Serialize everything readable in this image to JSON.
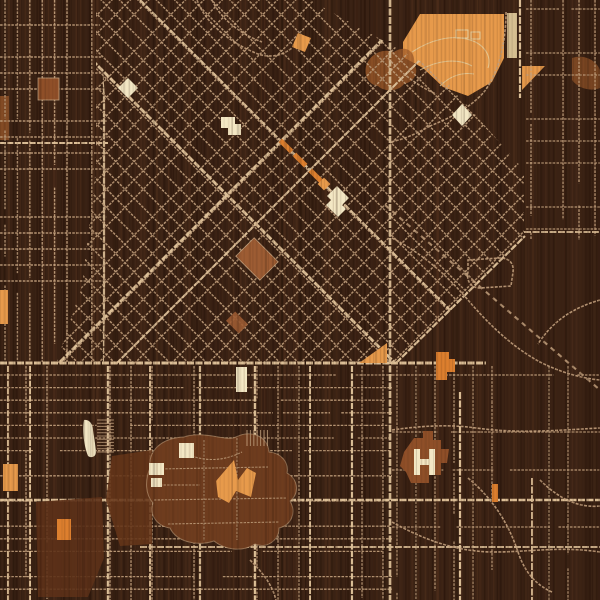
{
  "meta": {
    "title": "engraved-wood-city-street-map",
    "canvas_w": 600,
    "canvas_h": 600
  },
  "palette": {
    "bg": "#3a2214",
    "grainDark": "#231108",
    "grainLight": "#5a3620",
    "street": "#c2a07d",
    "streetBright": "#dcbf97",
    "cream": "#f3e7c4",
    "creamDim": "#e6cf9f",
    "orange": "#e79a4b",
    "orangeDeep": "#dd7f2e",
    "rust": "#a35d2b",
    "copper": "#8f4f28",
    "terracotta": "#9d5c33",
    "campus": "#6e3c1e",
    "campusB": "#5d3118",
    "campusA": "#653619"
  },
  "wood": {
    "stripe_step": 4,
    "stripe_count": 152,
    "plank_count": 13,
    "under_opacity": 0.32,
    "over_opacity": 0.14
  },
  "grids": [
    {
      "name": "left-ortho-grid",
      "kind": "ortho",
      "clip": "0,0 98,0 108,140 104,362 0,362",
      "bbox": [
        0,
        0,
        118,
        362
      ],
      "sx": 12.4,
      "sy": 16,
      "w": 1.4,
      "skipV": 0.08,
      "skipH": 0.3,
      "gap": 0.3,
      "majors": [
        {
          "axis": "v",
          "pos": 104,
          "w": 2.2,
          "a": 0,
          "b": 362
        },
        {
          "axis": "h",
          "pos": 143,
          "w": 2.0,
          "a": 0,
          "b": 110
        }
      ]
    },
    {
      "name": "downtown-diagonal-grid",
      "kind": "diag",
      "clip": "96,0 310,0 436,70 524,170 524,238 396,364 56,364 82,285 96,168",
      "bbox": [
        40,
        -20,
        540,
        380
      ],
      "spacing": 13,
      "w": 1.5,
      "skip": 0.07
    },
    {
      "name": "south-rows-grid",
      "kind": "ortho",
      "clip": "0,366 392,366 392,600 0,600",
      "bbox": [
        0,
        366,
        392,
        600
      ],
      "sx": 21,
      "sy": 12.6,
      "w": 1.3,
      "skipV": 0.45,
      "skipH": 0.12,
      "gap": 0.3,
      "majors": [
        {
          "axis": "v",
          "pos": 8,
          "w": 2.0,
          "a": 366,
          "b": 600
        },
        {
          "axis": "v",
          "pos": 30,
          "w": 2.0,
          "a": 366,
          "b": 600
        },
        {
          "axis": "v",
          "pos": 108,
          "w": 2.4,
          "a": 366,
          "b": 600
        },
        {
          "axis": "v",
          "pos": 150,
          "w": 2.0,
          "a": 366,
          "b": 600
        },
        {
          "axis": "v",
          "pos": 200,
          "w": 2.2,
          "a": 366,
          "b": 600
        },
        {
          "axis": "v",
          "pos": 255,
          "w": 2.4,
          "a": 366,
          "b": 600
        },
        {
          "axis": "v",
          "pos": 310,
          "w": 2.0,
          "a": 366,
          "b": 600
        },
        {
          "axis": "v",
          "pos": 352,
          "w": 2.2,
          "a": 366,
          "b": 600
        }
      ]
    },
    {
      "name": "northeast-ortho-grid",
      "kind": "ortho",
      "clip": "526,0 600,0 600,240 526,240",
      "bbox": [
        526,
        0,
        600,
        240
      ],
      "sx": 16,
      "sy": 22,
      "w": 1.3,
      "skipV": 0.25,
      "skipH": 0.3,
      "gap": 0.4,
      "majors": []
    },
    {
      "name": "southeast-sparse-grid",
      "kind": "ortho",
      "clip": "392,366 600,366 600,600 392,600",
      "bbox": [
        392,
        366,
        600,
        600
      ],
      "sx": 19,
      "sy": 19,
      "w": 1.2,
      "skipV": 0.5,
      "skipH": 0.5,
      "gap": 0.5,
      "majors": []
    }
  ],
  "major_roads": [
    {
      "name": "main-avenue-nw-se-1",
      "d": "M32,0 L394,362",
      "w": 2.8,
      "clip": 1
    },
    {
      "name": "main-avenue-nw-se-2",
      "d": "M140,0 L502,362",
      "w": 2.2,
      "clip": 1
    },
    {
      "name": "main-avenue-ne-sw-1",
      "d": "M60,362 L422,0",
      "w": 2.8,
      "clip": 1
    },
    {
      "name": "main-avenue-ne-sw-2",
      "d": "M116,364 L480,0",
      "w": 2.0,
      "clip": 1
    },
    {
      "name": "grid-edge-avenue",
      "d": "M396,363 L525,236",
      "w": 2.2
    },
    {
      "name": "cross-town-street",
      "d": "M0,363 L486,363",
      "w": 3.0
    },
    {
      "name": "south-arterial-1",
      "d": "M0,500 L600,500",
      "w": 2.4
    },
    {
      "name": "south-arterial-2",
      "d": "M140,547 L600,547",
      "w": 1.8
    },
    {
      "name": "north-south-arterial",
      "d": "M390,0 L390,600",
      "w": 2.6
    },
    {
      "name": "east-arterial",
      "d": "M460,392 L460,600",
      "w": 2.2
    },
    {
      "name": "park-east-street",
      "d": "M520,0 L520,98",
      "w": 2.2
    },
    {
      "name": "southeast-street",
      "d": "M532,478 L532,600",
      "w": 1.8
    },
    {
      "name": "northeast-cross-street",
      "d": "M524,232 L600,232",
      "w": 1.8
    }
  ],
  "railway": {
    "name": "railway-line",
    "d": "M385,205 L600,390",
    "w": 2.1,
    "dash": "5 4.5",
    "op": 0.85
  },
  "minor_roads": [
    {
      "name": "top-curve-road-1",
      "d": "M197,0 C205,22 228,42 258,54 C270,58 282,56 292,48"
    },
    {
      "name": "top-curve-road-2",
      "d": "M212,0 C220,18 240,34 262,42"
    },
    {
      "name": "park-edge-road",
      "d": "M506,12 C506,44 498,74 484,92 C470,108 450,118 430,126"
    },
    {
      "name": "park-connector-road",
      "d": "M388,58 C402,74 418,86 436,94"
    },
    {
      "name": "park-south-road",
      "d": "M430,126 C416,134 402,140 390,142"
    },
    {
      "name": "valley-curve-road-1",
      "d": "M392,238 C420,252 446,274 468,300 C490,326 514,348 540,362 C560,372 580,378 600,380"
    },
    {
      "name": "valley-curve-road-2",
      "d": "M600,300 C572,308 552,322 538,344"
    },
    {
      "name": "loop-road",
      "d": "M468,260 L500,258 C510,258 514,264 513,272 L511,286 L480,288 C472,288 466,282 468,272 Z"
    },
    {
      "name": "hospital-access-road",
      "d": "M392,430 C420,426 448,424 476,428 C520,434 560,430 600,428"
    },
    {
      "name": "southeast-curve-road-1",
      "d": "M468,478 C492,498 508,522 518,552 C524,570 534,584 552,592"
    },
    {
      "name": "southeast-curve-road-2",
      "d": "M392,522 C424,540 458,552 494,552 C530,552 560,546 600,552"
    },
    {
      "name": "southeast-curve-road-3",
      "d": "M540,480 C560,500 580,508 600,506"
    },
    {
      "name": "south-small-curve",
      "d": "M250,560 C262,572 272,584 276,600"
    }
  ],
  "regions_under": [
    {
      "name": "city-park",
      "shape": "polygon",
      "pts": "403,42 420,14 504,14 504,58 492,82 468,96 443,87 423,68 403,57",
      "fill": "orange"
    },
    {
      "name": "park-strip-field",
      "shape": "rect",
      "x": 507,
      "y": 13,
      "w": 10,
      "h": 45,
      "fill": "creamDim",
      "op": 0.9
    },
    {
      "name": "park-triangle",
      "shape": "polygon",
      "pts": "522,66 545,66 522,90",
      "fill": "orange"
    },
    {
      "name": "wood-knot-rust-patch",
      "shape": "path",
      "d": "M366,66 C370,54 382,48 394,52 C406,44 416,52 414,64 C420,72 414,82 404,84 C398,92 384,92 378,86 C368,84 364,76 366,66 Z",
      "fill": "rust",
      "op": 0.75
    },
    {
      "name": "rust-patch-east",
      "shape": "path",
      "d": "M572,58 C584,54 596,60 600,70 L600,88 C590,92 578,88 572,80 Z",
      "fill": "rust",
      "op": 0.6
    },
    {
      "name": "rust-strip-west",
      "shape": "rect",
      "x": 0,
      "y": 96,
      "w": 9,
      "h": 44,
      "fill": "rust",
      "op": 0.7
    }
  ],
  "regions_over": [
    {
      "name": "campus-area-west",
      "shape": "polygon",
      "pts": "112,456 152,450 152,544 120,546 106,500",
      "fill": "campusA",
      "op": 0.88
    },
    {
      "name": "campus-area-south",
      "shape": "polygon",
      "pts": "36,502 102,497 104,558 88,597 38,597",
      "fill": "campusB",
      "op": 0.9
    },
    {
      "name": "campus-main-blob",
      "shape": "path",
      "d": "M150,468 C148,450 162,438 184,437 C204,430 226,442 236,437 C252,429 268,437 269,452 C281,453 289,462 287,473 C299,480 299,494 290,501 C297,513 291,525 279,528 C279,541 266,549 255,544 C241,553 224,549 214,541 C196,547 176,541 170,528 C157,526 149,515 153,503 C145,494 145,480 150,468 Z",
      "fill": "campus",
      "stroke": "street",
      "sw": 1,
      "sop": 0.6
    },
    {
      "name": "hospital-building",
      "shape": "path",
      "d": "M400,466 L404,452 L414,438 L423,438 L423,431 L433,431 L433,440 L441,440 L441,449 L449,449 L447,463 L441,463 L441,475 L429,475 L429,483 L411,483 L406,472 Z",
      "fill": "copper"
    }
  ],
  "campus_paths": [
    {
      "name": "campus-walk",
      "d": "M158,469 L268,467"
    },
    {
      "name": "campus-walk",
      "d": "M154,500 L287,498"
    },
    {
      "name": "campus-walk",
      "d": "M168,524 L279,522"
    },
    {
      "name": "campus-walk",
      "d": "M204,440 L204,541"
    },
    {
      "name": "campus-walk",
      "d": "M237,438 L237,540"
    },
    {
      "name": "campus-walk",
      "d": "M182,452 C202,462 222,462 242,452"
    },
    {
      "name": "campus-walk",
      "d": "M160,485 L200,485"
    }
  ],
  "park_trails": [
    {
      "name": "park-trail",
      "d": "M412,52 C430,40 452,34 470,40 C484,44 492,56 488,68"
    },
    {
      "name": "park-trail",
      "d": "M420,70 C438,60 458,58 472,66"
    },
    {
      "name": "park-trail",
      "d": "M440,86 C450,76 462,72 474,74"
    }
  ],
  "combs": [
    {
      "name": "trailer-rows",
      "x": 97,
      "y": 420,
      "n": 11,
      "step": 3.2,
      "len": 17,
      "dir": "h"
    },
    {
      "name": "parking-rows",
      "x": 247,
      "y": 430,
      "n": 7,
      "step": 3.4,
      "len": 16,
      "dir": "v"
    }
  ],
  "landmarks": [
    {
      "name": "park-shelter-outline",
      "shape": "rect",
      "x": 456,
      "y": 30,
      "w": 12,
      "h": 8,
      "fill": "none",
      "stroke": "creamDim",
      "sw": 1
    },
    {
      "name": "park-shelter-outline",
      "shape": "rect",
      "x": 471,
      "y": 32,
      "w": 9,
      "h": 7,
      "fill": "none",
      "stroke": "creamDim",
      "sw": 1
    },
    {
      "name": "copper-block",
      "shape": "rect",
      "x": 38,
      "y": 78,
      "w": 21,
      "h": 22,
      "fill": "copper",
      "stroke": "street",
      "sw": 0.8
    },
    {
      "name": "landmark-diamond-west",
      "shape": "polygon",
      "pts": "128,78 138,88 128,98 118,88",
      "fill": "cream"
    },
    {
      "name": "landmark-L-building",
      "shape": "path",
      "d": "M221,117 L235,117 L235,124 L241,124 L241,135 L228,135 L228,128 L221,128 Z",
      "fill": "cream"
    },
    {
      "name": "orange-parallelogram",
      "shape": "polygon",
      "pts": "298,33 311,38 305,52 292,47",
      "fill": "orange"
    },
    {
      "name": "avenue-orange-strip",
      "shape": "rect",
      "x": 278,
      "y": 143.5,
      "w": 16,
      "h": 5,
      "rot": 45,
      "fill": "orangeDeep"
    },
    {
      "name": "avenue-orange-strip",
      "shape": "rect",
      "x": 292,
      "y": 157.5,
      "w": 16,
      "h": 5,
      "rot": 45,
      "fill": "orangeDeep"
    },
    {
      "name": "avenue-orange-strip",
      "shape": "rect",
      "x": 308,
      "y": 173.5,
      "w": 16,
      "h": 5,
      "rot": 45,
      "fill": "orangeDeep"
    },
    {
      "name": "avenue-orange-block",
      "shape": "rect",
      "x": 319.5,
      "y": 179.5,
      "w": 9,
      "h": 9,
      "rot": 45,
      "fill": "orange"
    },
    {
      "name": "landmark-G-building",
      "shape": "path",
      "d": "M327,196 L337,186 L349,198 L342,205 L346,209 L338,217 L326,205 L331,200 Z",
      "fill": "cream"
    },
    {
      "name": "terracotta-block-large",
      "shape": "rect",
      "x": 240,
      "y": 246,
      "w": 34,
      "h": 26,
      "rot": 45,
      "fill": "terracotta",
      "stroke": "street",
      "sw": 0.8
    },
    {
      "name": "terracotta-block-small",
      "shape": "rect",
      "x": 228,
      "y": 316,
      "w": 18,
      "h": 13,
      "rot": 45,
      "fill": "terracotta",
      "op": 0.9
    },
    {
      "name": "landmark-diamond-east",
      "shape": "polygon",
      "pts": "462,104 472,115 462,126 452,115",
      "fill": "cream"
    },
    {
      "name": "orange-pennant",
      "shape": "polygon",
      "pts": "359,363 387,343 387,363",
      "fill": "orange"
    },
    {
      "name": "orange-stair-block",
      "shape": "path",
      "d": "M436,352 L449,352 L449,359 L455,359 L455,372 L447,372 L447,380 L436,380 Z",
      "fill": "orangeDeep"
    },
    {
      "name": "orange-strip-west-edge",
      "shape": "rect",
      "x": 0,
      "y": 290,
      "w": 8,
      "h": 34,
      "fill": "orange"
    },
    {
      "name": "orange-block-west",
      "shape": "rect",
      "x": 3,
      "y": 464,
      "w": 15,
      "h": 27,
      "fill": "orange"
    },
    {
      "name": "orange-block-south",
      "shape": "rect",
      "x": 57,
      "y": 519,
      "w": 14,
      "h": 21,
      "fill": "orangeDeep"
    },
    {
      "name": "orange-sliver-east",
      "shape": "rect",
      "x": 492,
      "y": 484,
      "w": 6,
      "h": 18,
      "fill": "orangeDeep"
    },
    {
      "name": "campus-orange-halls",
      "shape": "path",
      "d": "M216,481 L234,460 L238,480 L247,468 L256,473 L251,497 L236,491 L229,503 L218,497 Z",
      "fill": "orange"
    },
    {
      "name": "campus-cream-hall",
      "shape": "rect",
      "x": 179,
      "y": 443,
      "w": 15,
      "h": 15,
      "fill": "cream"
    },
    {
      "name": "campus-cream-hall",
      "shape": "rect",
      "x": 149,
      "y": 463,
      "w": 15,
      "h": 12,
      "fill": "cream"
    },
    {
      "name": "campus-cream-hall",
      "shape": "rect",
      "x": 151,
      "y": 478,
      "w": 11,
      "h": 9,
      "fill": "cream"
    },
    {
      "name": "cream-sliver-pool",
      "shape": "path",
      "d": "M84,420 C89,419 93,424 93,430 L96,450 C97,456 92,459 88,456 C84,446 82,430 84,420 Z",
      "fill": "cream"
    },
    {
      "name": "cream-tall-building",
      "shape": "rect",
      "x": 236,
      "y": 367,
      "w": 11,
      "h": 25,
      "fill": "cream"
    },
    {
      "name": "hospital-H-bar",
      "shape": "rect",
      "x": 414,
      "y": 449,
      "w": 6,
      "h": 26,
      "fill": "cream"
    },
    {
      "name": "hospital-H-bar",
      "shape": "rect",
      "x": 429,
      "y": 449,
      "w": 6,
      "h": 26,
      "fill": "cream"
    },
    {
      "name": "hospital-H-crossbar",
      "shape": "rect",
      "x": 418,
      "y": 459,
      "w": 13,
      "h": 6,
      "fill": "cream"
    }
  ]
}
